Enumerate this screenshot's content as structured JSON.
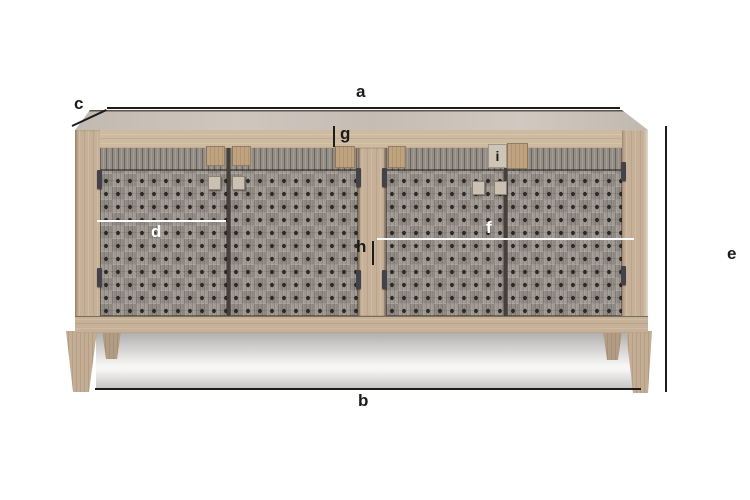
{
  "scene": {
    "description": "Product dimension diagram of a four-door sideboard with woven rope doors on a white background",
    "background": "#ffffff"
  },
  "annotations": {
    "a": "a",
    "b": "b",
    "c": "c",
    "d": "d",
    "e": "e",
    "f": "f",
    "g": "g",
    "h": "h",
    "i": "i"
  },
  "colors": {
    "dimension_line": "#1c1c1c",
    "label_dark": "#1b1b1b",
    "label_light": "#ffffff",
    "wood": "#c6b097",
    "wood_light": "#cdbaa1",
    "weave": "#98918a",
    "weave_hole": "#2d2925",
    "top_surface": "#c8c0b7",
    "floor_shadow": "#b0aeac"
  }
}
